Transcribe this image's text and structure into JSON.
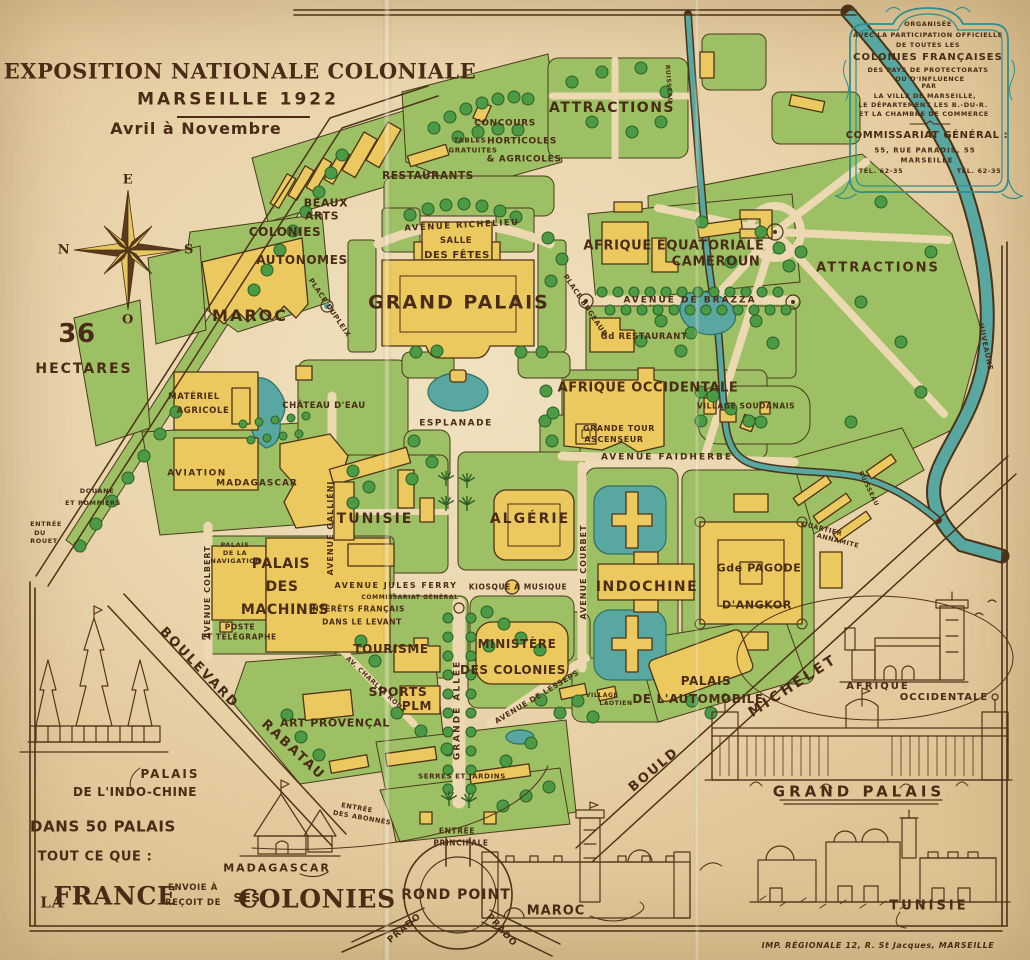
{
  "title": {
    "line1": "EXPOSITION NATIONALE COLONIALE",
    "line2": "MARSEILLE 1922",
    "line3": "Avril à Novembre"
  },
  "compass": {
    "top": "E",
    "left": "N",
    "right": "S",
    "bottom": "O"
  },
  "area": {
    "value": "36",
    "unit": "HECTARES"
  },
  "cartouche": {
    "l1": "ORGANISÉE",
    "l2": "AVEC LA PARTICIPATION OFFICIELLE",
    "l3": "DE TOUTES LES",
    "l4": "COLONIES FRANÇAISES",
    "l5": "DES PAYS DE PROTECTORATS",
    "l6": "OU D'INFLUENCE",
    "l7": "PAR",
    "l8": "LA VILLE DE MARSEILLE,",
    "l9": "LE DÉPARTEMENT LES B.-DU-R.",
    "l10": "ET LA CHAMBRE DE COMMERCE",
    "l11": "COMMISSARIAT GÉNÉRAL :",
    "l12": "55, RUE PARADIS, 55",
    "l13": "MARSEILLE",
    "tel_left": "TÉL. 62-35",
    "tel_right": "TÉL. 62-35"
  },
  "map": {
    "attractions_top": "ATTRACTIONS",
    "attractions_right": "ATTRACTIONS",
    "concours_l1": "CONCOURS",
    "concours_l2": "HORTICOLES",
    "concours_l3": "& AGRICOLES",
    "tables_l1": "TABLES",
    "tables_l2": "GRATUITES",
    "restaurants": "RESTAURANTS",
    "beaux_l1": "BEAUX",
    "beaux_l2": "ARTS",
    "colonies_l1": "COLONIES",
    "colonies_l2": "AUTONOMES",
    "av_richelieu": "AVENUE RICHELIEU",
    "salle_l1": "SALLE",
    "salle_l2": "DES FÊTES",
    "grand_palais": "GRAND PALAIS",
    "place_bugeaud": "PLACE BUGEAUD",
    "place_dupleix": "PLACE DUPLEIX",
    "afrique_eq": "AFRIQUE EQUATORIALE",
    "cameroun": "CAMEROUN",
    "av_brazza": "AVENUE DE BRAZZA",
    "gd_restaurant": "Gd RESTAURANT",
    "afrique_occ": "AFRIQUE OCCIDENTALE",
    "village_soudanais": "VILLAGE SOUDANAIS",
    "tour_l1": "GRANDE TOUR",
    "tour_l2": "ASCENSEUR",
    "av_faidherbe": "AVENUE FAIDHERBE",
    "maroc": "MAROC",
    "chateau": "CHÂTEAU D'EAU",
    "esplanade": "ESPLANADE",
    "materiel_l1": "MATÉRIEL",
    "materiel_l2": "AGRICOLE",
    "aviation": "AVIATION",
    "madagascar": "MADAGASCAR",
    "douane_l1": "DOUANE",
    "douane_l2": "ET POMPIERS",
    "rouet_l1": "ENTRÉE",
    "rouet_l2": "DU",
    "rouet_l3": "ROUET",
    "av_gallieni": "AVENUE GALLIÉNI",
    "navigation_l1": "PALAIS",
    "navigation_l2": "DE LA",
    "navigation_l3": "NAVIGATION",
    "av_colbert": "AVENUE COLBERT",
    "machines_l1": "PALAIS",
    "machines_l2": "DES",
    "machines_l3": "MACHINES",
    "poste_l1": "POSTE",
    "poste_l2": "ET TÉLÉGRAPHE",
    "tunisie": "TUNISIE",
    "algerie": "ALGÉRIE",
    "av_jules_ferry": "AVENUE JULES FERRY",
    "commissariat": "COMMISSARIAT GÉNÉRAL",
    "interets_l1": "INTÉRÊTS FRANÇAIS",
    "interets_l2": "DANS LE LEVANT",
    "kiosque": "KIOSQUE À MUSIQUE",
    "av_courbet": "AVENUE COURBET",
    "indochine": "INDOCHINE",
    "pagode_l1": "Gde PAGODE",
    "pagode_l2": "D'ANGKOR",
    "quartier_l1": "QUARTIER",
    "quartier_l2": "ANNAMITE",
    "ruisseau": "RUISSEAU",
    "huveaune": "HUVEAUNE",
    "tourisme": "TOURISME",
    "sports": "SPORTS",
    "plm": "PLM",
    "av_charles_roux": "AV. CHARLES ROUX",
    "art_provencal": "ART PROVENÇAL",
    "serres": "SERRES ET JARDINS",
    "abonnes_l1": "ENTRÉE",
    "abonnes_l2": "DES ABONNÉS",
    "grande_allee": "GRANDE ALLÉE",
    "ministere_l1": "MINISTÈRE",
    "ministere_l2": "DES COLONIES",
    "av_lesseps": "AVENUE DE LESSEPS",
    "laotien_l1": "VILLAGE",
    "laotien_l2": "LAOTIEN",
    "automobile_l1": "PALAIS",
    "automobile_l2": "DE L'AUTOMOBILE",
    "michelet_l1": "BOULD",
    "michelet_l2": "MICHELET",
    "rabatau_l1": "BOULEVARD",
    "rabatau_l2": "RABATAU",
    "principale_l1": "ENTRÉE",
    "principale_l2": "PRINCIPALE",
    "rond_point": "ROND POINT",
    "prado": "PRADO"
  },
  "vignett": {
    "indochine_l1": "PALAIS",
    "indochine_l2": "DE L'INDO-CHINE",
    "madagascar": "MADAGASCAR",
    "maroc": "MAROC",
    "grand_palais": "GRAND PALAIS",
    "afrique_l1": "AFRIQUE",
    "afrique_l2": "OCCIDENTALE",
    "tunisie": "TUNISIE"
  },
  "slogan": {
    "l1": "DANS 50 PALAIS",
    "l2": "TOUT CE QUE :",
    "la": "LA",
    "france": "FRANCE",
    "envoie": "ENVOIE À",
    "recoit": "REÇOIT DE",
    "ses": "SES",
    "colonies": "COLONIES"
  },
  "imprint": "IMP. RÉGIONALE 12, R. St Jacques, MARSEILLE",
  "colors": {
    "paper": "#e9d4ab",
    "green": "#9cc063",
    "tree": "#4d9a45",
    "building": "#ecc95e",
    "water": "#58a7a0",
    "ink": "#4a2c16",
    "cartouche_teal": "#2e8e8e"
  }
}
